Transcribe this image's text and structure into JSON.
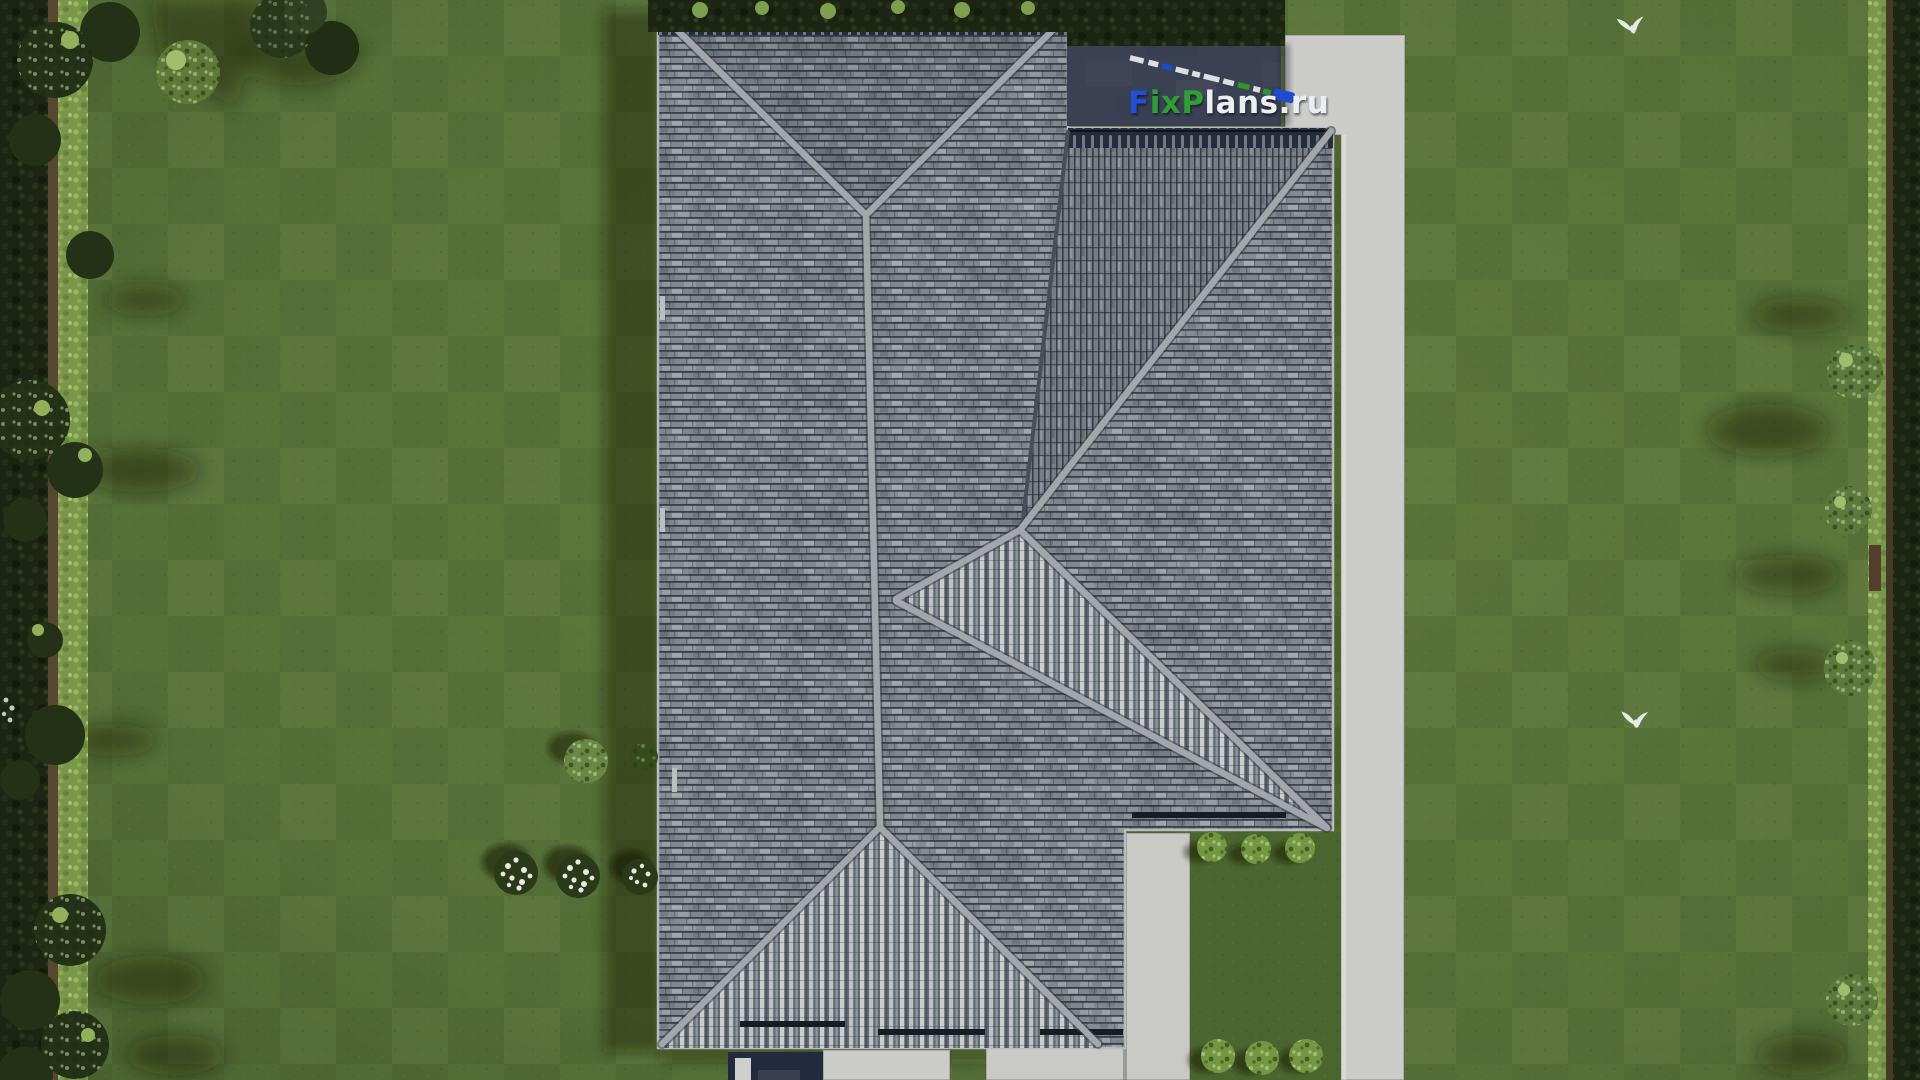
{
  "watermark": {
    "full_text": "FixPlans.ru",
    "segments": {
      "f": "F",
      "ix": "ix",
      "p": "P",
      "lans": "lans",
      "domain": ".ru"
    },
    "colors": {
      "f": "#2050d8",
      "ix": "#2f9e33",
      "p": "#2f9e33",
      "lans": "#eceef2",
      "domain": "#eceef2"
    }
  },
  "palette": {
    "lawn": "#5e7b3d",
    "lawn_dark": "#4c6830",
    "courtyard_lawn": "#4e6a31",
    "path_concrete": "#d6d6d3",
    "roof_tile_base": "#878c96",
    "roof_row_line": "#3b414d",
    "roof_ridge": "#abafb5",
    "roof_stripe_light": "#d6d8da",
    "roof_stripe_dark": "#595f6a",
    "roof_eave_dark": "#272e3d",
    "flat_roof_navy": "#3d4457",
    "porch_navy": "#232c42",
    "hedge_dark": "#1c2613",
    "hedge_light": "#7f9e4e",
    "fence_brown": "#5a4a33",
    "flower_white": "#f2f4ee",
    "bird_white": "#f4f6f2"
  },
  "scene": {
    "view": "aerial-top-down-3d-render",
    "subject": "hip-roof house with lawn, hedges, concrete paths",
    "birds_count": 2,
    "flower_clusters_count": 3,
    "courtyard_bushes_count": 6
  }
}
